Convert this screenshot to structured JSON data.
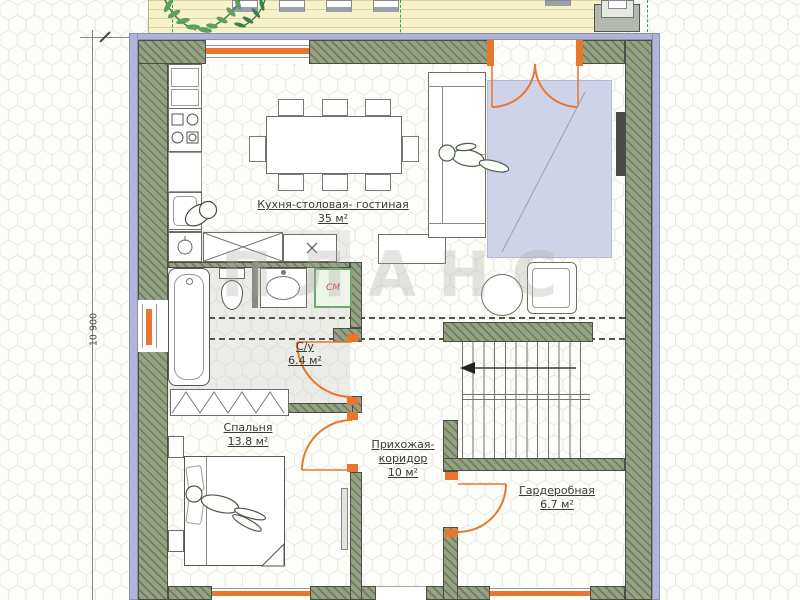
{
  "floorplan": {
    "watermark": "ПЛАНС",
    "dimension": {
      "left_height": "10 900"
    },
    "rooms": {
      "kitchen_living": {
        "name": "Кухня-столовая- гостиная",
        "area": "35 м²"
      },
      "bathroom": {
        "name": "С/у",
        "area": "6.4 м²"
      },
      "bedroom": {
        "name": "Спальня",
        "area": "13.8 м²"
      },
      "hallway": {
        "name_line1": "Прихожая-",
        "name_line2": "коридор",
        "area": "10 м²"
      },
      "wardrobe": {
        "name": "Гардеробная",
        "area": "6.7 м²"
      }
    },
    "appliances": {
      "washing_machine": "СМ"
    },
    "colors": {
      "wall": "#94a283",
      "outline": "#4e4e46",
      "band": "#b1b4d8",
      "accent": "#e8772c",
      "terrace": "#f6f2c9",
      "terrace_line": "#d9d2a2",
      "carpet": "#ced3ea",
      "carpet_border": "#b4b9d6",
      "hex_line": "#e8e8e1",
      "washer_green": "#74a474",
      "washer_fill": "#edf4e8",
      "washer_text": "#cc4040",
      "label": "#3b3b33",
      "stair_line": "#73736c",
      "figure": "#4c5c4c",
      "furn_border": "#6e6e66",
      "dash": "#55554e",
      "axis_green": "#2fa065",
      "dim": "#8a8a84",
      "tv": "#4a4a48",
      "watermark": "#a9a99e"
    }
  }
}
